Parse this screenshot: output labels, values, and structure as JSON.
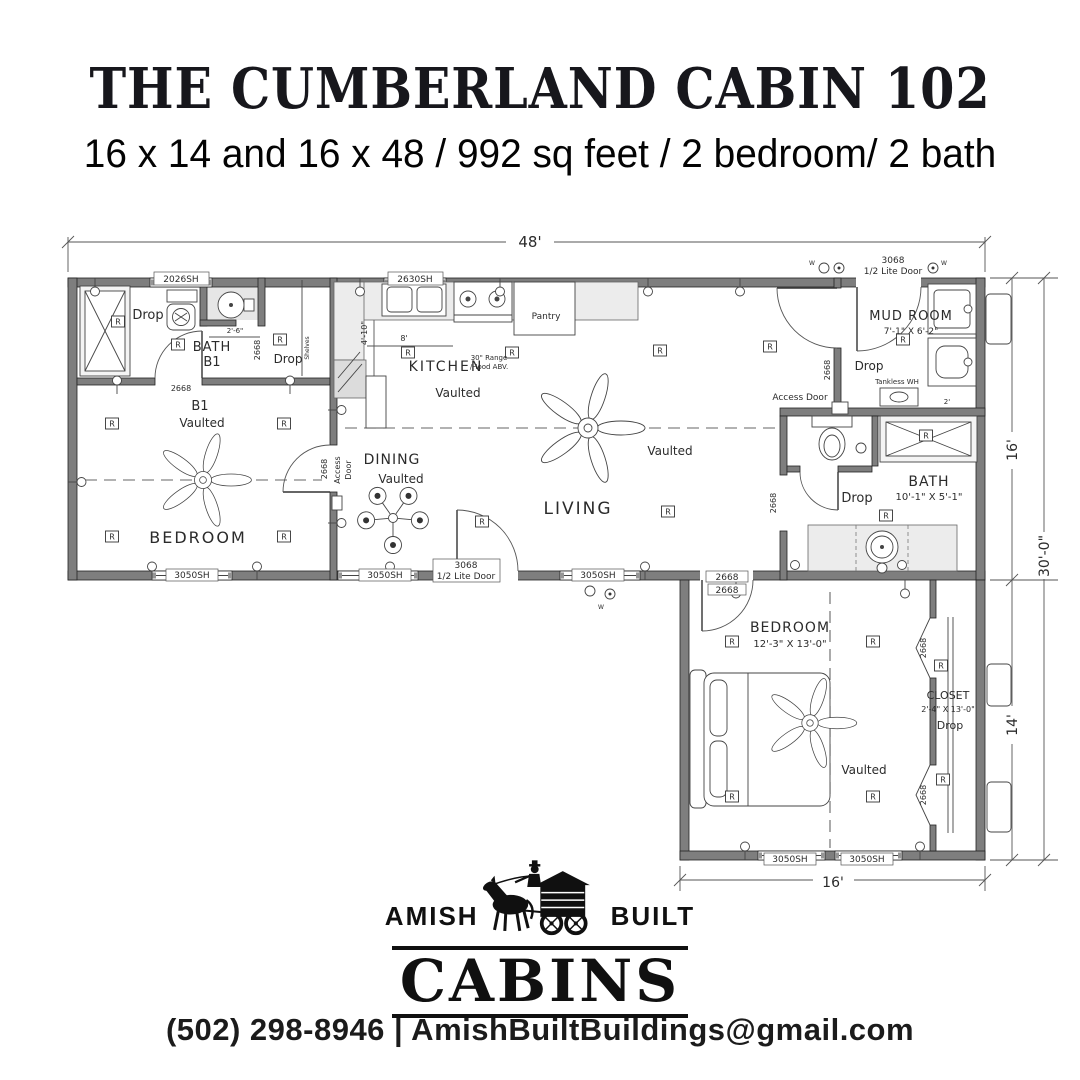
{
  "header": {
    "title": "THE CUMBERLAND CABIN 102",
    "subtitle": "16 x 14 and 16 x 48 / 992 sq feet / 2 bedroom/ 2 bath"
  },
  "plan": {
    "receptacle_symbol": "R",
    "receptacles": [
      [
        112,
        204
      ],
      [
        284,
        204
      ],
      [
        112,
        317
      ],
      [
        284,
        317
      ],
      [
        178,
        125
      ],
      [
        118,
        102
      ],
      [
        280,
        120
      ],
      [
        408,
        133
      ],
      [
        512,
        133
      ],
      [
        660,
        131
      ],
      [
        770,
        127
      ],
      [
        668,
        292
      ],
      [
        482,
        302
      ],
      [
        903,
        120
      ],
      [
        926,
        216
      ],
      [
        886,
        296
      ],
      [
        732,
        422
      ],
      [
        873,
        422
      ],
      [
        732,
        577
      ],
      [
        873,
        577
      ],
      [
        941,
        446
      ],
      [
        943,
        560
      ]
    ],
    "labels": [
      {
        "n": "dim-width-main",
        "t": "48'",
        "x": 530,
        "y": 27,
        "s": 15
      },
      {
        "n": "dim-height-main",
        "t": "16'",
        "x": 1017,
        "y": 230,
        "s": 14,
        "r": -90
      },
      {
        "n": "dim-height-overall",
        "t": "30'-0\"",
        "x": 1049,
        "y": 336,
        "s": 14,
        "r": -90
      },
      {
        "n": "dim-height-wing",
        "t": "14'",
        "x": 1017,
        "y": 505,
        "s": 14,
        "r": -90
      },
      {
        "n": "dim-width-wing",
        "t": "16'",
        "x": 833,
        "y": 667,
        "s": 14
      },
      {
        "n": "tag-window-2026sh",
        "t": "2026SH",
        "x": 181,
        "y": 62,
        "s": 9
      },
      {
        "n": "tag-window-2630sh",
        "t": "2630SH",
        "x": 415,
        "y": 62,
        "s": 9
      },
      {
        "n": "tag-door-3068-back-a",
        "t": "3068",
        "x": 893,
        "y": 43,
        "s": 9
      },
      {
        "n": "tag-door-3068-back-b",
        "t": "1/2 Lite Door",
        "x": 893,
        "y": 54,
        "s": 9
      },
      {
        "n": "tag-window-3050sh-1",
        "t": "3050SH",
        "x": 192,
        "y": 358,
        "s": 9
      },
      {
        "n": "tag-window-3050sh-2",
        "t": "3050SH",
        "x": 385,
        "y": 358,
        "s": 9
      },
      {
        "n": "tag-door-3068-front-a",
        "t": "3068",
        "x": 466,
        "y": 348,
        "s": 9
      },
      {
        "n": "tag-door-3068-front-b",
        "t": "1/2 Lite Door",
        "x": 466,
        "y": 359,
        "s": 9
      },
      {
        "n": "tag-window-3050sh-3",
        "t": "3050SH",
        "x": 598,
        "y": 358,
        "s": 9
      },
      {
        "n": "tag-door-2668-wing-a",
        "t": "2668",
        "x": 727,
        "y": 360,
        "s": 9
      },
      {
        "n": "tag-door-2668-wing-b",
        "t": "2668",
        "x": 727,
        "y": 373,
        "s": 9
      },
      {
        "n": "tag-window-3050sh-4",
        "t": "3050SH",
        "x": 790,
        "y": 642,
        "s": 9
      },
      {
        "n": "tag-window-3050sh-5",
        "t": "3050SH",
        "x": 867,
        "y": 642,
        "s": 9
      },
      {
        "n": "tag-door-2668-bath-b1",
        "t": "2668",
        "x": 181,
        "y": 171,
        "s": 8
      },
      {
        "n": "tag-door-2668-closet-b1",
        "t": "2668",
        "x": 260,
        "y": 130,
        "s": 8,
        "r": -90
      },
      {
        "n": "tag-door-2668-bedroom-b1",
        "t": "2668",
        "x": 327,
        "y": 249,
        "s": 8,
        "r": -90
      },
      {
        "n": "label-access-door-left-a",
        "t": "Access",
        "x": 340,
        "y": 250,
        "s": 8,
        "r": -90
      },
      {
        "n": "label-access-door-left-b",
        "t": "Door",
        "x": 351,
        "y": 250,
        "s": 8,
        "r": -90
      },
      {
        "n": "tag-door-2668-mudroom",
        "t": "2668",
        "x": 830,
        "y": 150,
        "s": 8,
        "r": -90
      },
      {
        "n": "tag-door-2668-hall",
        "t": "2668",
        "x": 776,
        "y": 283,
        "s": 8,
        "r": -90
      },
      {
        "n": "tag-door-2668-closet-top",
        "t": "2668",
        "x": 926,
        "y": 428,
        "s": 8,
        "r": -90
      },
      {
        "n": "tag-door-2668-closet-bottom",
        "t": "2668",
        "x": 926,
        "y": 575,
        "s": 8,
        "r": -90
      },
      {
        "n": "label-access-door-right",
        "t": "Access Door",
        "x": 800,
        "y": 180,
        "s": 9
      },
      {
        "n": "label-drop-bath-b1",
        "t": "Drop",
        "x": 148,
        "y": 99,
        "s": 13
      },
      {
        "n": "label-bath-b1-a",
        "t": "BATH",
        "x": 212,
        "y": 131,
        "s": 13,
        "ls": 1
      },
      {
        "n": "label-bath-b1-b",
        "t": "B1",
        "x": 212,
        "y": 146,
        "s": 13
      },
      {
        "n": "label-dim-2-6",
        "t": "2'-6\"",
        "x": 235,
        "y": 113,
        "s": 7
      },
      {
        "n": "label-shelves",
        "t": "Shelves",
        "x": 309,
        "y": 128,
        "s": 6,
        "r": -90
      },
      {
        "n": "label-drop-closet-b1",
        "t": "Drop",
        "x": 288,
        "y": 143,
        "s": 12
      },
      {
        "n": "label-b1",
        "t": "B1",
        "x": 200,
        "y": 190,
        "s": 13
      },
      {
        "n": "label-b1-vaulted",
        "t": "Vaulted",
        "x": 202,
        "y": 207,
        "s": 12
      },
      {
        "n": "label-bedroom-b1",
        "t": "BEDROOM",
        "x": 198,
        "y": 323,
        "s": 16,
        "ls": 2
      },
      {
        "n": "label-kitchen",
        "t": "KITCHEN",
        "x": 446,
        "y": 151,
        "s": 14,
        "ls": 2
      },
      {
        "n": "label-kitchen-vaulted",
        "t": "Vaulted",
        "x": 458,
        "y": 177,
        "s": 12
      },
      {
        "n": "label-pantry",
        "t": "Pantry",
        "x": 546,
        "y": 99,
        "s": 9
      },
      {
        "n": "label-range-a",
        "t": "30\" Range",
        "x": 489,
        "y": 140,
        "s": 7
      },
      {
        "n": "label-range-b",
        "t": "/Hood ABV.",
        "x": 489,
        "y": 149,
        "s": 7
      },
      {
        "n": "label-dim-4-10",
        "t": "4'-10\"",
        "x": 367,
        "y": 113,
        "s": 8,
        "r": -90
      },
      {
        "n": "label-dim-8",
        "t": "8'",
        "x": 404,
        "y": 121,
        "s": 8
      },
      {
        "n": "label-dining",
        "t": "DINING",
        "x": 392,
        "y": 244,
        "s": 14,
        "ls": 1
      },
      {
        "n": "label-dining-vaulted",
        "t": "Vaulted",
        "x": 401,
        "y": 263,
        "s": 12
      },
      {
        "n": "label-living",
        "t": "LIVING",
        "x": 578,
        "y": 294,
        "s": 17,
        "ls": 2
      },
      {
        "n": "label-living-vaulted",
        "t": "Vaulted",
        "x": 670,
        "y": 235,
        "s": 12
      },
      {
        "n": "label-mud-room",
        "t": "MUD ROOM",
        "x": 911,
        "y": 100,
        "s": 13,
        "ls": 1
      },
      {
        "n": "label-mud-room-dim",
        "t": "7'-1\" X 6'-2\"",
        "x": 911,
        "y": 114,
        "s": 9
      },
      {
        "n": "label-drop-mud",
        "t": "Drop",
        "x": 869,
        "y": 150,
        "s": 12
      },
      {
        "n": "label-tankless",
        "t": "Tankless WH",
        "x": 897,
        "y": 164,
        "s": 7
      },
      {
        "n": "label-bath2",
        "t": "BATH",
        "x": 929,
        "y": 266,
        "s": 14,
        "ls": 1
      },
      {
        "n": "label-bath2-dim",
        "t": "10'-1\" X 5'-1\"",
        "x": 929,
        "y": 280,
        "s": 10
      },
      {
        "n": "label-drop-bath2",
        "t": "Drop",
        "x": 857,
        "y": 282,
        "s": 13
      },
      {
        "n": "label-dim-2",
        "t": "2'",
        "x": 947,
        "y": 184,
        "s": 7
      },
      {
        "n": "label-bedroom2",
        "t": "BEDROOM",
        "x": 790,
        "y": 412,
        "s": 14,
        "ls": 1
      },
      {
        "n": "label-bedroom2-dim",
        "t": "12'-3\" X 13'-0\"",
        "x": 790,
        "y": 427,
        "s": 10
      },
      {
        "n": "label-bedroom2-vaulted",
        "t": "Vaulted",
        "x": 864,
        "y": 554,
        "s": 12
      },
      {
        "n": "label-closet",
        "t": "CLOSET",
        "x": 948,
        "y": 479,
        "s": 11
      },
      {
        "n": "label-closet-dim",
        "t": "2'-4\" X 13'-0\"",
        "x": 948,
        "y": 492,
        "s": 8
      },
      {
        "n": "label-closet-drop",
        "t": "Drop",
        "x": 950,
        "y": 509,
        "s": 11
      },
      {
        "n": "label-w-light-1",
        "t": "W",
        "x": 812,
        "y": 45,
        "s": 6
      },
      {
        "n": "label-w-light-2",
        "t": "W",
        "x": 944,
        "y": 45,
        "s": 6
      },
      {
        "n": "label-w-light-3",
        "t": "W",
        "x": 601,
        "y": 389,
        "s": 6
      }
    ]
  },
  "logo": {
    "amish": "AMISH",
    "built": "BUILT",
    "cabins": "CABINS"
  },
  "footer": {
    "contact": "(502) 298-8946 | AmishBuiltBuildings@gmail.com"
  }
}
